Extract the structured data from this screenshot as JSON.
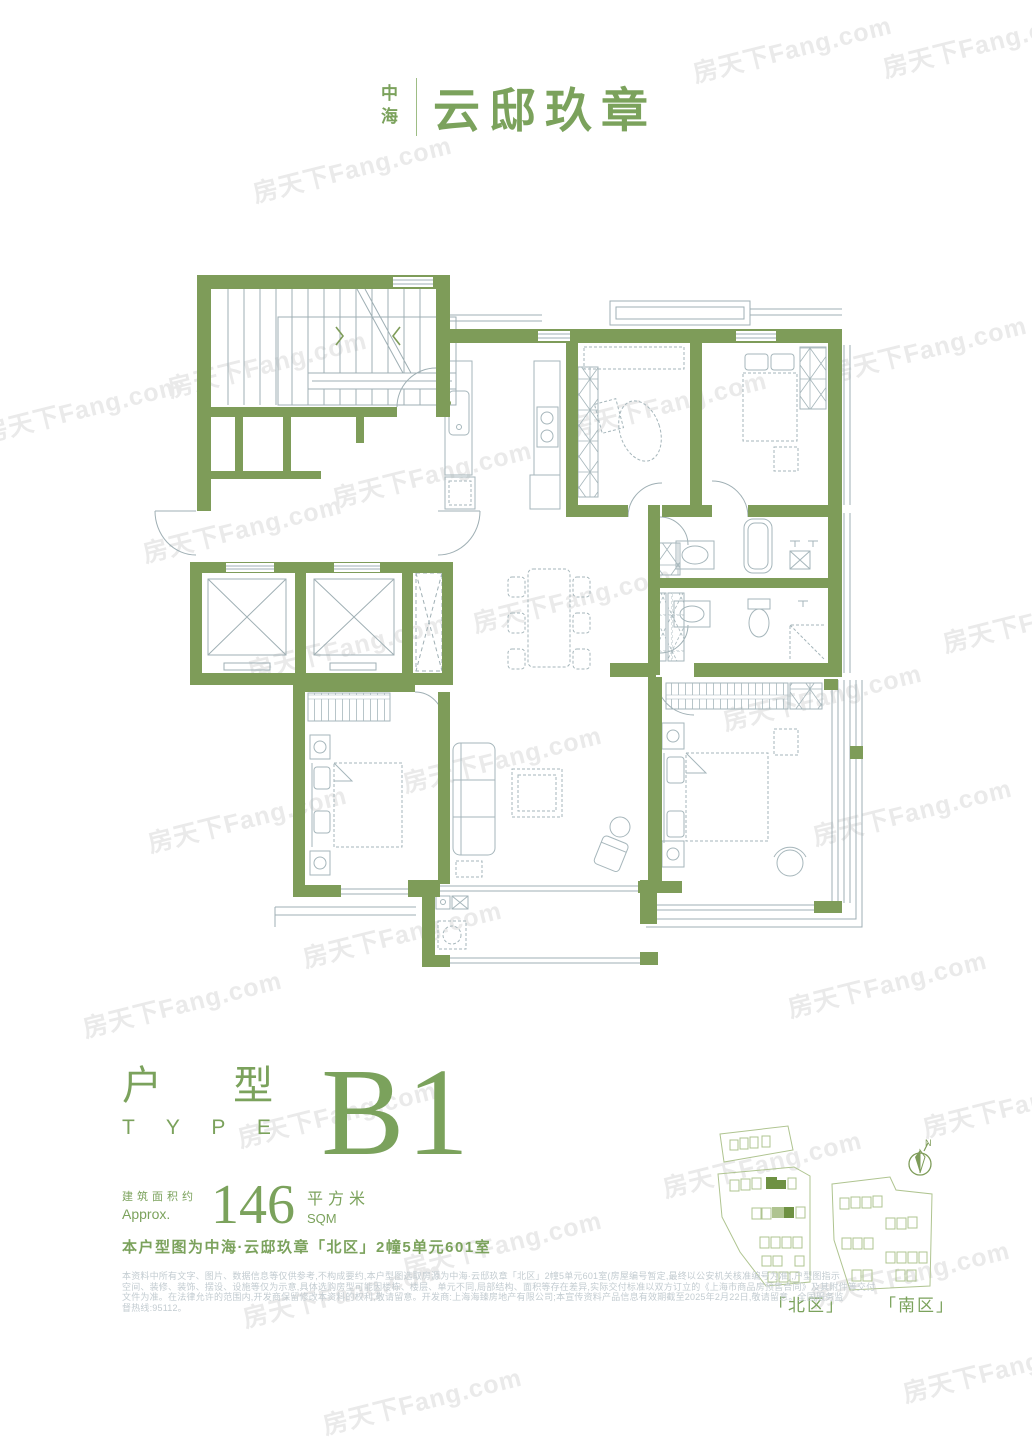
{
  "header": {
    "brand_small": "中海",
    "brand_main": "云邸玖章"
  },
  "watermark": {
    "text": "房天下Fang.com"
  },
  "type_section": {
    "label_cn": "户 型",
    "label_en": "T Y P E",
    "type_code": "B1"
  },
  "area_section": {
    "approx_cn": "建筑面积约",
    "approx_en": "Approx.",
    "value": "146",
    "unit_cn": "平方米",
    "unit_en": "SQM"
  },
  "caption": "本户型图为中海·云邸玖章「北区」2幢5单元601室",
  "disclaimer": {
    "line1": "本资料中所有文字、图片、数据信息等仅供参考,不构成要约,本户型图选取房源为中海·云邸玖章「北区」2幢5单元601室(房屋编号暂定,最终以公安机关核准编号为准),户型图指示",
    "line2": "空间、装修、装饰、摆设、设施等仅为示意,具体选购房型可能因楼栋、楼层、单元不同,局部结构、面积等存在差异,实际交付标准以双方订立的《上海市商品房预售合同》及其附件等交付",
    "line3": "文件为准。在法律允许的范围内,开发商保留修改本资料的权利,敬请留意。开发商:上海海臻房地产有限公司;本宣传资料产品信息有效期截至2025年2月22日,敬请留意。全国服务监",
    "line4": "督热线:95112。"
  },
  "siteplan": {
    "north_label": "「北区」",
    "south_label": "「南区」",
    "compass_letter": "N"
  },
  "colors": {
    "wall_green": "#7e9c59",
    "text_green": "#7ba25c",
    "highlight_dark_green": "#6e9142",
    "highlight_light_green": "#afc490",
    "thin_line": "#9fafb4",
    "furniture_line": "#a6b6bb",
    "disclaimer_gray": "#c3ccd1",
    "watermark_gray": "#eaeaea"
  }
}
